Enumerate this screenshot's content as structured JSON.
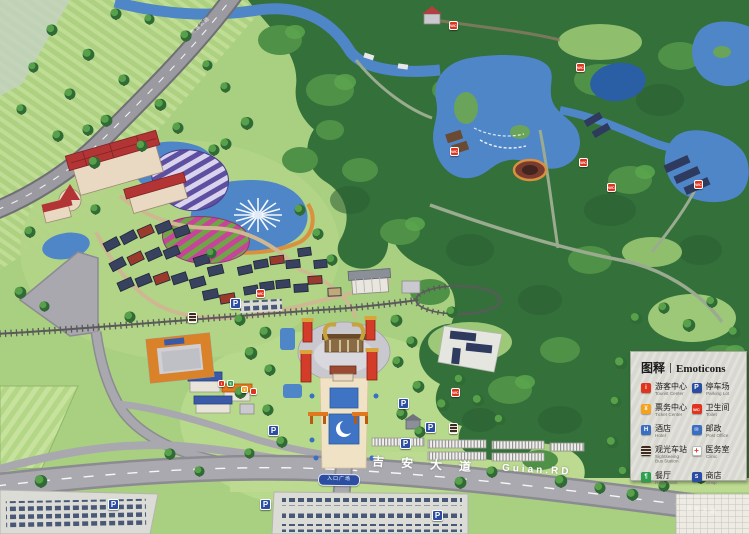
{
  "legend": {
    "title_zh": "图释",
    "title_en": "Emoticons",
    "panel_color": "#d8d8d1",
    "items": [
      {
        "zh": "游客中心",
        "en": "Tourist Center",
        "color": "#e0341e",
        "glyph": "i",
        "icon": "tourist-center-icon"
      },
      {
        "zh": "停车场",
        "en": "Parking Lot",
        "color": "#2b4ea2",
        "glyph": "P",
        "icon": "parking-icon"
      },
      {
        "zh": "票务中心",
        "en": "Ticket Center",
        "color": "#f5a31e",
        "glyph": "¥",
        "icon": "ticket-center-icon"
      },
      {
        "zh": "卫生间",
        "en": "Toilet",
        "color": "#e0341e",
        "glyph": "WC",
        "icon": "toilet-icon"
      },
      {
        "zh": "酒店",
        "en": "Hotel",
        "color": "#3a6ec0",
        "glyph": "H",
        "icon": "hotel-icon"
      },
      {
        "zh": "邮政",
        "en": "Post Office",
        "color": "#3a6ec0",
        "glyph": "✉",
        "icon": "post-icon"
      },
      {
        "zh": "观光车站",
        "en": "Sightseeing Bus Station",
        "color": "#3c2b1e",
        "glyph": "",
        "icon": "bus-station-icon"
      },
      {
        "zh": "医务室",
        "en": "Clinic",
        "color": "#ffffff",
        "glyph": "+",
        "icon": "clinic-icon"
      },
      {
        "zh": "餐厅",
        "en": "Restaurant",
        "color": "#2e9e4f",
        "glyph": "¶",
        "icon": "restaurant-icon"
      },
      {
        "zh": "商店",
        "en": "Shop",
        "color": "#2b4ea2",
        "glyph": "S",
        "icon": "shop-icon"
      }
    ]
  },
  "roads": {
    "main_name_zh": "吉安大道",
    "main_name_en": "Guian.RD",
    "main_name_faint": "吉安大道",
    "highway_label": "高速公路",
    "entrance_sign": "入口广场"
  },
  "icons": {
    "parking_glyph": "P",
    "toilet_glyph": "WC",
    "info_glyph": "i",
    "restaurant_glyph": "¶",
    "ticket_glyph": "¥"
  },
  "map_colors": {
    "grass": "#a9cf80",
    "forest": "#33703a",
    "water": "#4f86c8",
    "road": "#a9a9af",
    "path": "#cdb891",
    "plaza": "#f0e2c4",
    "temple_red": "#d23c28",
    "temple_gold": "#c8a23c",
    "hotel_roof": "#b23434",
    "village_roof": "#38425e",
    "flower_purple": "#5f4fa0",
    "flower_pink": "#c8439a"
  }
}
